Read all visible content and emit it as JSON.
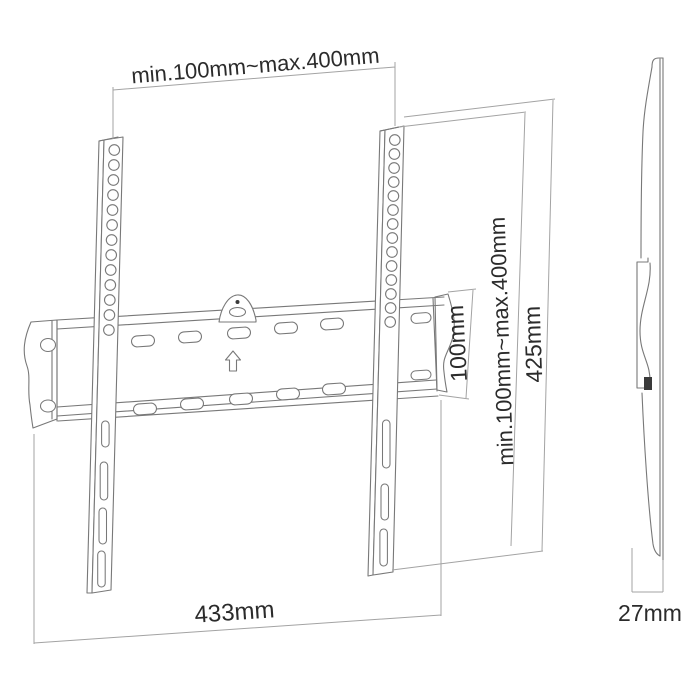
{
  "page": {
    "background": "#ffffff"
  },
  "diagram": {
    "kind": "technical-line-drawing",
    "colors": {
      "background": "#ffffff",
      "outline": "#787878",
      "dimension": "#a3a3a3",
      "label_text": "#2b2b2b",
      "accent_fill": "#3a3a3a"
    },
    "icons": {
      "up_arrow": "⇧"
    },
    "front_view": {
      "dimensions": {
        "top_width": "min.100mm~max.400mm",
        "plate_height": "100mm",
        "vesa_height": "min.100mm~max.400mm",
        "total_height": "425mm",
        "bottom_width": "433mm"
      }
    },
    "side_view": {
      "dimensions": {
        "depth": "27mm"
      }
    }
  }
}
